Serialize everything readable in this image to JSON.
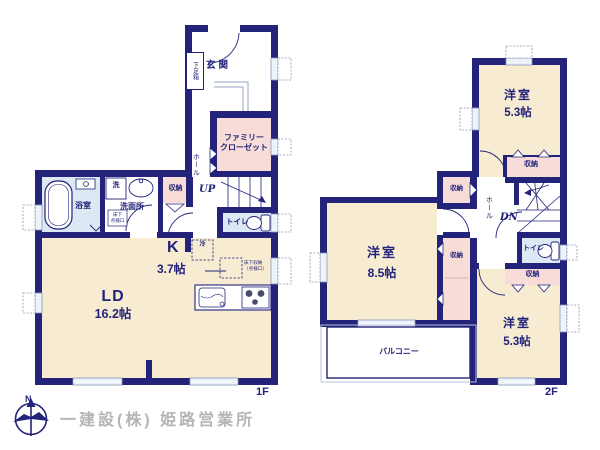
{
  "meta": {
    "floor1_label": "1F",
    "floor2_label": "2F",
    "company": "一建設(株) 姫路営業所",
    "compass_north": "N"
  },
  "colors": {
    "wall_navy": "#23237a",
    "room_cream": "#f7ecd2",
    "closet_pink": "#f8dcd8",
    "wet_area_blue": "#dce8f4",
    "text_navy": "#23237a",
    "company_gray": "#b5b5b5",
    "window_fill": "#eef2fa"
  },
  "floor1": {
    "entrance": "玄関",
    "shoe_box": "下足箱",
    "family_closet_line1": "ファミリー",
    "family_closet_line2": "クローゼット",
    "hall": "ホール",
    "up": "UP",
    "storage": "収納",
    "bathroom": "浴室",
    "washer": "洗",
    "washroom": "洗面所",
    "inspection_line1": "床下",
    "inspection_line2": "点検口",
    "toilet": "トイレ",
    "kitchen": "K",
    "kitchen_size": "3.7帖",
    "fridge": "冷",
    "underfloor_line1": "床下収納",
    "underfloor_line2": "（点検口）",
    "living": "LD",
    "living_size": "16.2帖"
  },
  "floor2": {
    "room_top": "洋室",
    "room_top_size": "5.3帖",
    "room_mid": "洋室",
    "room_mid_size": "8.5帖",
    "room_bottom": "洋室",
    "room_bottom_size": "5.3帖",
    "storage": "収納",
    "hall": "ホール",
    "dn": "DN",
    "toilet": "トイレ",
    "balcony": "バルコニー"
  }
}
